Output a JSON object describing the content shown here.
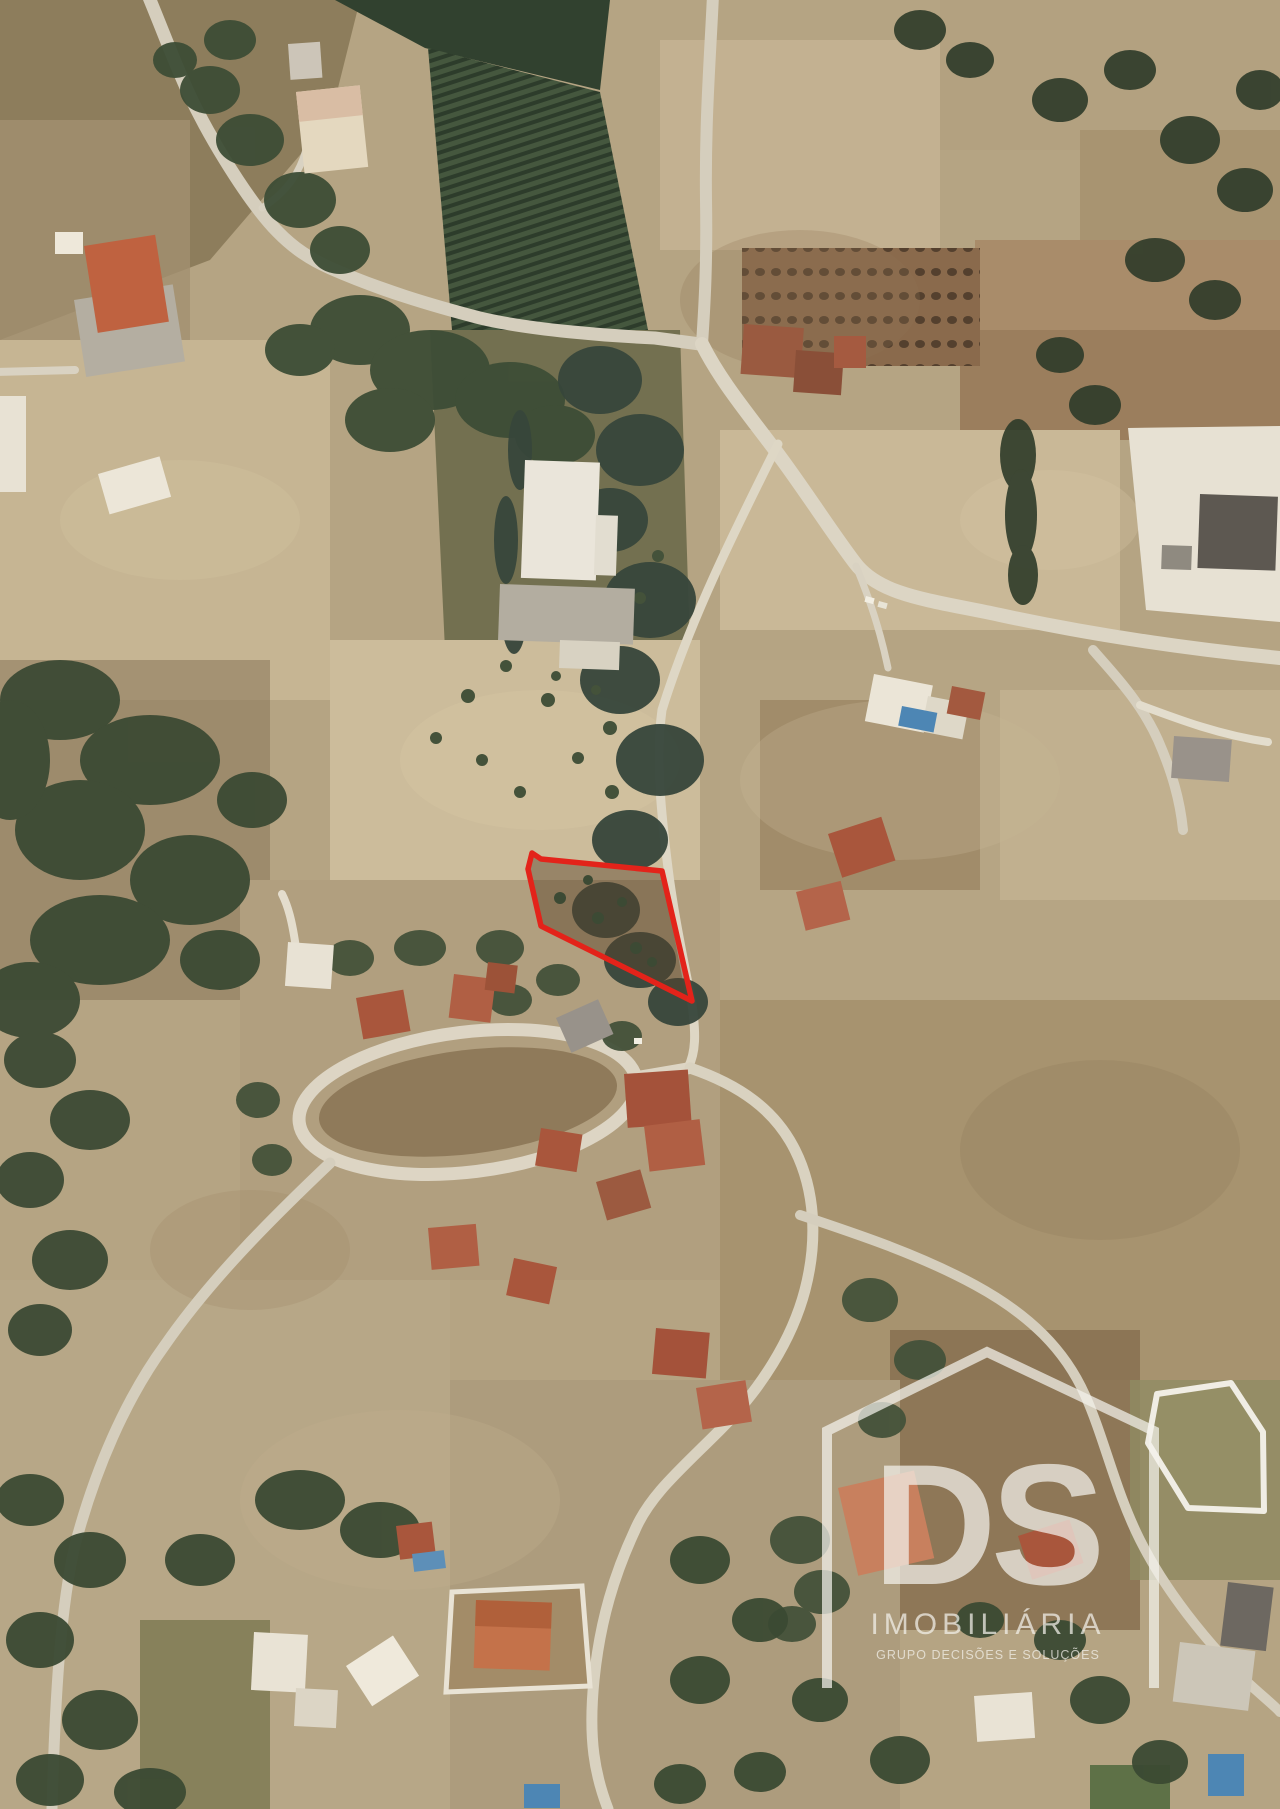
{
  "plot": {
    "points": "528,869 532,853 541,859 662,871 692,1001 541,926",
    "outline_color": "#e3231a",
    "fill": "rgba(88,66,42,0.45)"
  },
  "white_parcel": {
    "points": "1157,1394 1231,1383 1263,1432 1264,1511 1188,1508 1148,1443",
    "color": "#f0ede4"
  },
  "watermark": {
    "initials": "DS",
    "brand": "IMOBILIÁRIA",
    "tagline": "GRUPO DECISÕES E SOLUÇÕES",
    "color": "#f4f2ec",
    "pentagon_points": "827,1688 827,1431 987,1352 1154,1431 1154,1688"
  }
}
